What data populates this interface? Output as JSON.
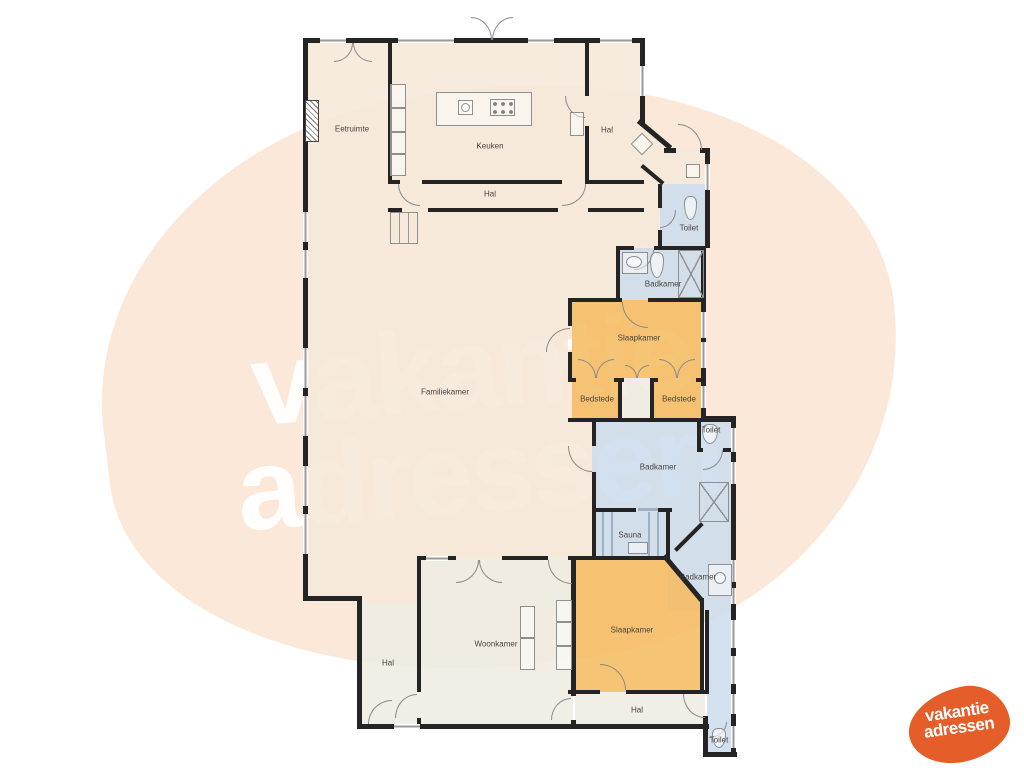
{
  "watermark": {
    "line1": "vakantie",
    "line2": "adressen"
  },
  "logo": {
    "line1": "vakantie",
    "line2": "adressen"
  },
  "colors": {
    "wall": "#242424",
    "pink": "#f6e8da",
    "cream": "#efece1",
    "orange": "#f5bc62",
    "blue": "#cddced",
    "label": "#4a443f",
    "blob": "#fce8d8",
    "wm_text": "rgba(255,255,255,0.95)",
    "logo_orange": "#e55d28"
  },
  "rooms": [
    {
      "id": "eetruimte",
      "label": "Eetruimte",
      "x": 352,
      "y": 129
    },
    {
      "id": "keuken",
      "label": "Keuken",
      "x": 490,
      "y": 146
    },
    {
      "id": "hal-boven",
      "label": "Hal",
      "x": 607,
      "y": 130
    },
    {
      "id": "hal-keuken",
      "label": "Hal",
      "x": 490,
      "y": 194
    },
    {
      "id": "toilet-1",
      "label": "Toilet",
      "x": 689,
      "y": 228
    },
    {
      "id": "badkamer-1",
      "label": "Badkamer",
      "x": 663,
      "y": 284
    },
    {
      "id": "slaapkamer-1",
      "label": "Slaapkamer",
      "x": 639,
      "y": 338
    },
    {
      "id": "bedstede-links",
      "label": "Bedstede",
      "x": 597,
      "y": 399
    },
    {
      "id": "bedstede-rechts",
      "label": "Bedstede",
      "x": 679,
      "y": 399
    },
    {
      "id": "toilet-2",
      "label": "Toilet",
      "x": 711,
      "y": 430
    },
    {
      "id": "badkamer-2",
      "label": "Badkamer",
      "x": 658,
      "y": 467
    },
    {
      "id": "sauna",
      "label": "Sauna",
      "x": 630,
      "y": 535
    },
    {
      "id": "badkamer-3",
      "label": "Badkamer",
      "x": 698,
      "y": 577
    },
    {
      "id": "slaapkamer-2",
      "label": "Slaapkamer",
      "x": 632,
      "y": 630
    },
    {
      "id": "woonkamer",
      "label": "Woonkamer",
      "x": 496,
      "y": 644
    },
    {
      "id": "hal-links",
      "label": "Hal",
      "x": 388,
      "y": 663
    },
    {
      "id": "hal-onder",
      "label": "Hal",
      "x": 637,
      "y": 710
    },
    {
      "id": "toilet-3",
      "label": "Toilet",
      "x": 719,
      "y": 740
    },
    {
      "id": "familiekamer",
      "label": "Familiekamer",
      "x": 445,
      "y": 392
    }
  ]
}
